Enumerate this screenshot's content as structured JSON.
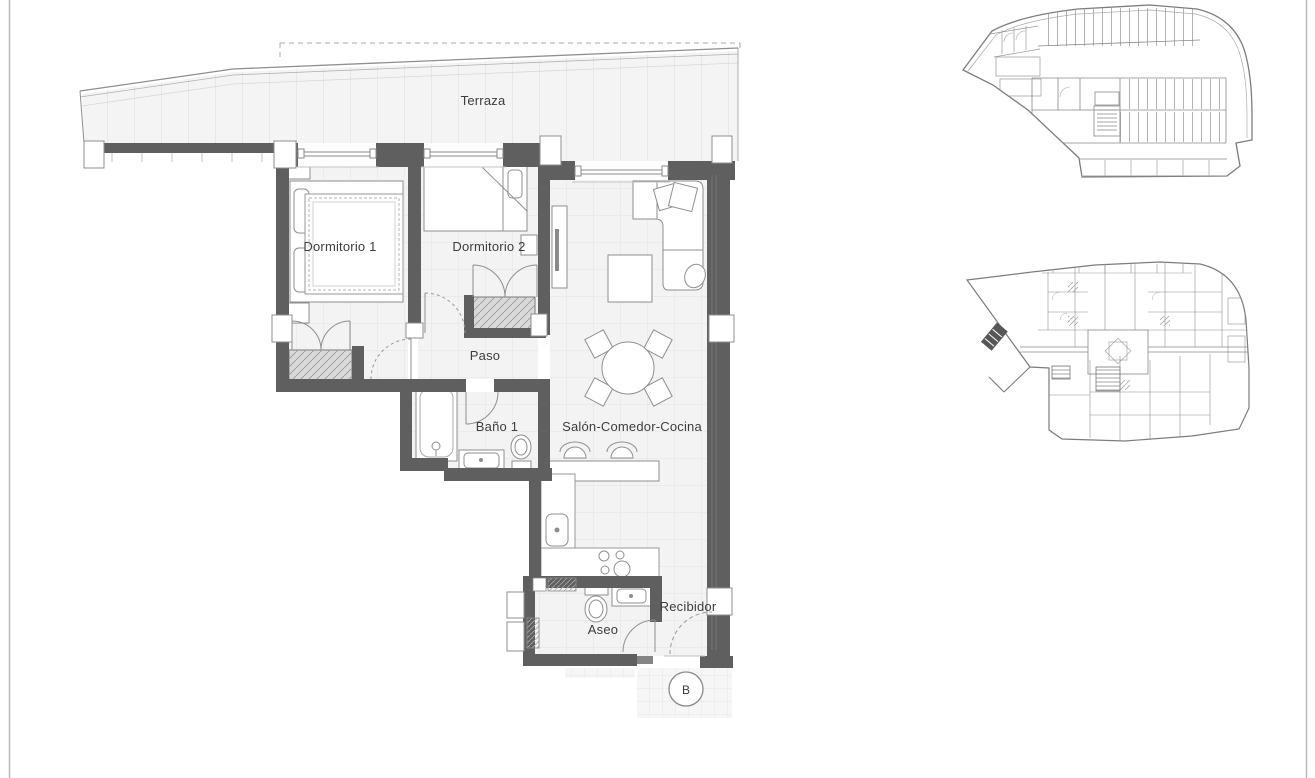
{
  "plan": {
    "labels": {
      "terraza": "Terraza",
      "dormitorio1": "Dormitorio 1",
      "dormitorio2": "Dormitorio 2",
      "paso": "Paso",
      "bano1": "Baño 1",
      "salon": "Salón-Comedor-Cocina",
      "aseo": "Aseo",
      "recibidor": "Recibidor"
    },
    "section_marker": "B"
  },
  "colors": {
    "wall": "#5f5f5f",
    "floor": "#f3f3f3",
    "floor_grid": "#e3e3e3",
    "furniture": "#8f8f8f",
    "label_text": "#3d3d3d",
    "wardrobe_fill": "#d9d9d9",
    "outline": "#9a9a9a",
    "page_border": "#b8b8b8"
  }
}
